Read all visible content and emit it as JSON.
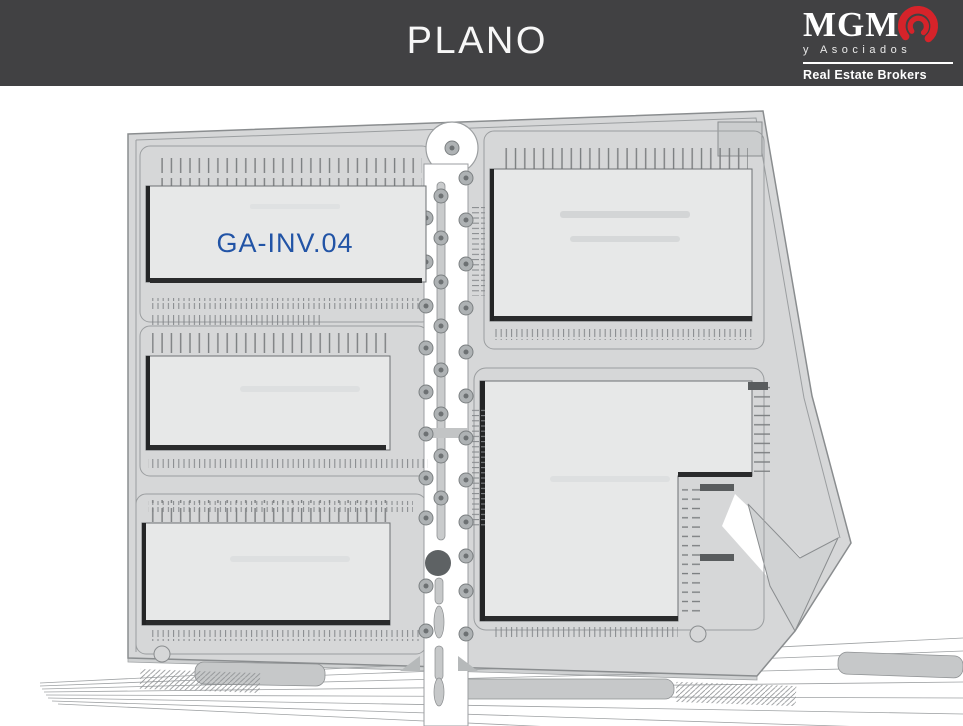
{
  "header": {
    "title": "PLANO",
    "background_color": "#414143",
    "text_color": "#f7f7f7"
  },
  "logo": {
    "name": "MGM",
    "subtitle": "y Asociados",
    "tagline": "Real Estate Brokers",
    "accent_color": "#d6232a"
  },
  "plan": {
    "type": "industrial-park-site-plan",
    "background": "#ffffff",
    "site_fill": "#d6d7d8",
    "building_fill": "#e7e8e8",
    "road_color": "#ffffff",
    "label_color": "#2254a6",
    "buildings": [
      {
        "id": "top-left",
        "label": "GA-INV.04"
      },
      {
        "id": "middle-left",
        "label": ""
      },
      {
        "id": "bottom-left",
        "label": ""
      },
      {
        "id": "top-right",
        "label": ""
      },
      {
        "id": "bottom-right",
        "label": ""
      }
    ]
  }
}
